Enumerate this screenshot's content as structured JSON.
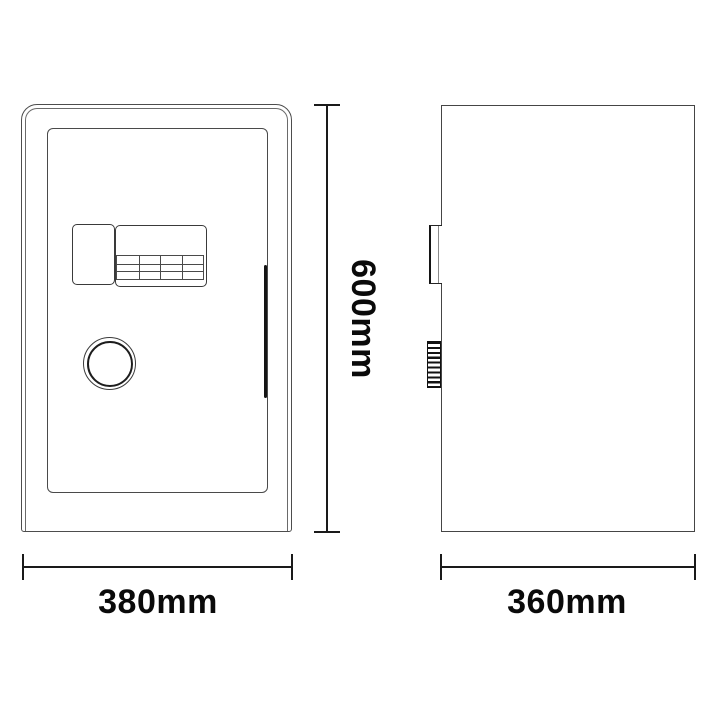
{
  "diagram": {
    "kind": "technical-drawing",
    "subject": "safe-box two-view dimension diagram",
    "views": [
      {
        "id": "front",
        "name": "front view"
      },
      {
        "id": "side",
        "name": "side view"
      }
    ],
    "dimensions": {
      "height": {
        "label": "600mm",
        "value_mm": 600,
        "orientation": "vertical"
      },
      "width": {
        "label": "380mm",
        "value_mm": 380,
        "orientation": "horizontal"
      },
      "depth": {
        "label": "360mm",
        "value_mm": 360,
        "orientation": "horizontal"
      }
    },
    "colors": {
      "background": "#ffffff",
      "drawing_line": "#4a4a4a",
      "dimension_line": "#1a1a1a",
      "text": "#0a0a0a"
    }
  }
}
